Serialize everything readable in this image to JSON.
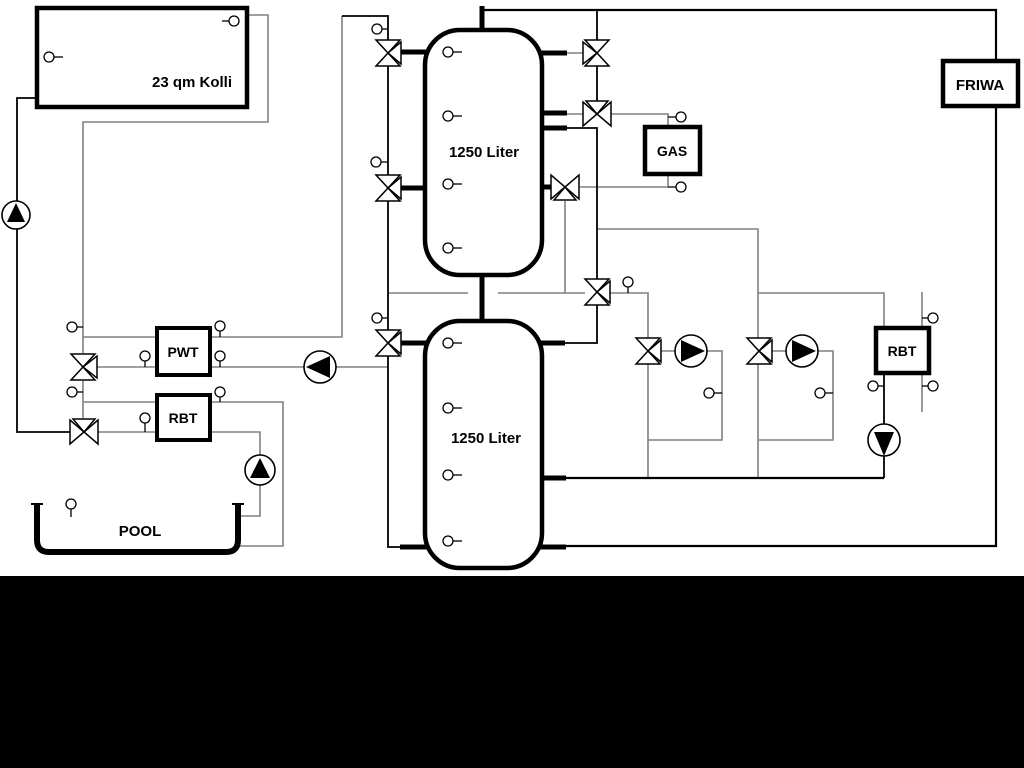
{
  "diagram": {
    "collector": {
      "label": "23 qm Kolli"
    },
    "tank_top": {
      "label": "1250 Liter"
    },
    "tank_bottom": {
      "label": "1250 Liter"
    },
    "pwt": {
      "label": "PWT"
    },
    "rbt_pool": {
      "label": "RBT"
    },
    "gas": {
      "label": "GAS"
    },
    "rbt_right": {
      "label": "RBT"
    },
    "friwa": {
      "label": "FRIWA"
    },
    "pool": {
      "label": "POOL"
    }
  },
  "colors": {
    "background": "#ffffff",
    "pipe_primary": "#000000",
    "pipe_secondary": "#808080",
    "footer_band": "#000000"
  }
}
